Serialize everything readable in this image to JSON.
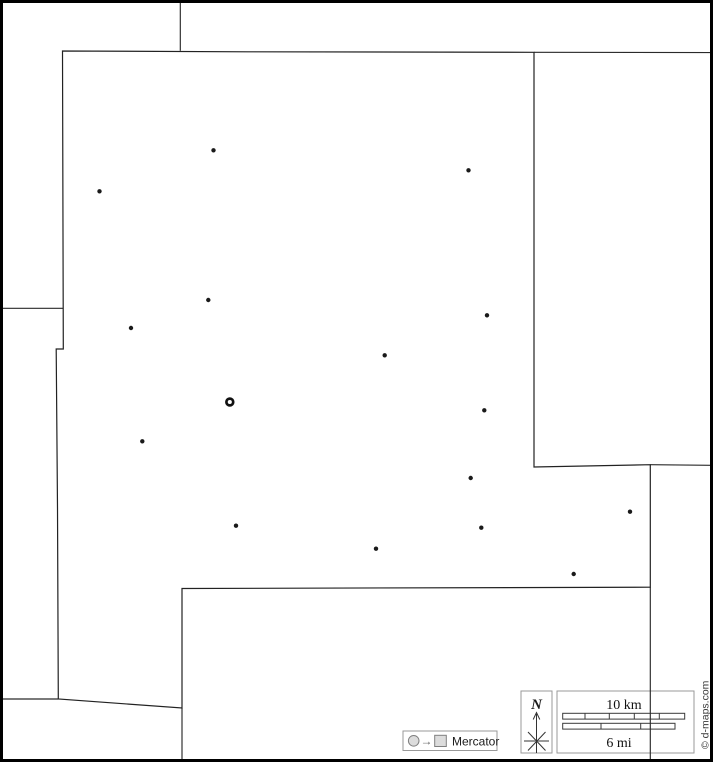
{
  "canvas": {
    "width": 713,
    "height": 762,
    "background": "#ffffff",
    "frame_color": "#000000"
  },
  "map": {
    "line_color": "#2a2a2a",
    "main_region_path": "M 62.5,51 L 63.2,308.3 L 63.3,349 L 56.2,349 L 57.5,508 L 58.3,699 L 182,708 L 182,588.5 L 650.3,587.2 L 650.3,464.7 L 534,467 L 534,52.3 L 248,51.8 Z",
    "neighbor_paths": [
      "M 180.3,2 L 180.3,50.8",
      "M 534,52.3 L 711,52.6",
      "M 2,308.3 L 63.2,308.3",
      "M 2,699 L 58.3,699",
      "M 650.3,464.7 L 711,465.3",
      "M 650.3,587.2 L 650.3,760",
      "M 182,708 L 182,760"
    ],
    "towns": [
      {
        "x": 213.5,
        "y": 150.3
      },
      {
        "x": 99.5,
        "y": 191.3
      },
      {
        "x": 468.5,
        "y": 170.3
      },
      {
        "x": 208.3,
        "y": 300.0
      },
      {
        "x": 487.0,
        "y": 315.3
      },
      {
        "x": 131.0,
        "y": 328.0
      },
      {
        "x": 384.7,
        "y": 355.3
      },
      {
        "x": 484.3,
        "y": 410.3
      },
      {
        "x": 142.3,
        "y": 441.3
      },
      {
        "x": 470.7,
        "y": 478.0
      },
      {
        "x": 630.0,
        "y": 511.7
      },
      {
        "x": 236.0,
        "y": 525.7
      },
      {
        "x": 481.3,
        "y": 527.7
      },
      {
        "x": 376.0,
        "y": 548.7
      },
      {
        "x": 573.7,
        "y": 574.0
      }
    ],
    "dot_radius": 2.2,
    "dot_color": "#1a1a1a",
    "county_seat": {
      "x": 229.8,
      "y": 402,
      "ring_radius": 3.4
    }
  },
  "legend": {
    "north": {
      "label": "N"
    },
    "scale": {
      "km_label": "10 km",
      "mi_label": "6 mi",
      "bar_fill": "#c8c8c8",
      "km_bar": {
        "x": 562.7,
        "y": 713.3,
        "width": 122,
        "height": 5.8,
        "ticks": [
          585.0,
          609.3,
          634.3,
          659.3
        ],
        "gray_segments": [
          [
            562.7,
            585.0
          ],
          [
            609.3,
            634.3
          ],
          [
            659.3,
            684.7
          ]
        ]
      },
      "mi_bar": {
        "x": 562.7,
        "y": 723.3,
        "width": 112.3,
        "height": 5.8,
        "ticks": [
          601.0,
          640.7
        ],
        "gray_segments": [
          [
            601.0,
            640.7
          ]
        ]
      }
    },
    "projection": {
      "label": "Mercator",
      "arrow_glyph": "→"
    },
    "credit": {
      "text": "© d-maps.com"
    }
  }
}
